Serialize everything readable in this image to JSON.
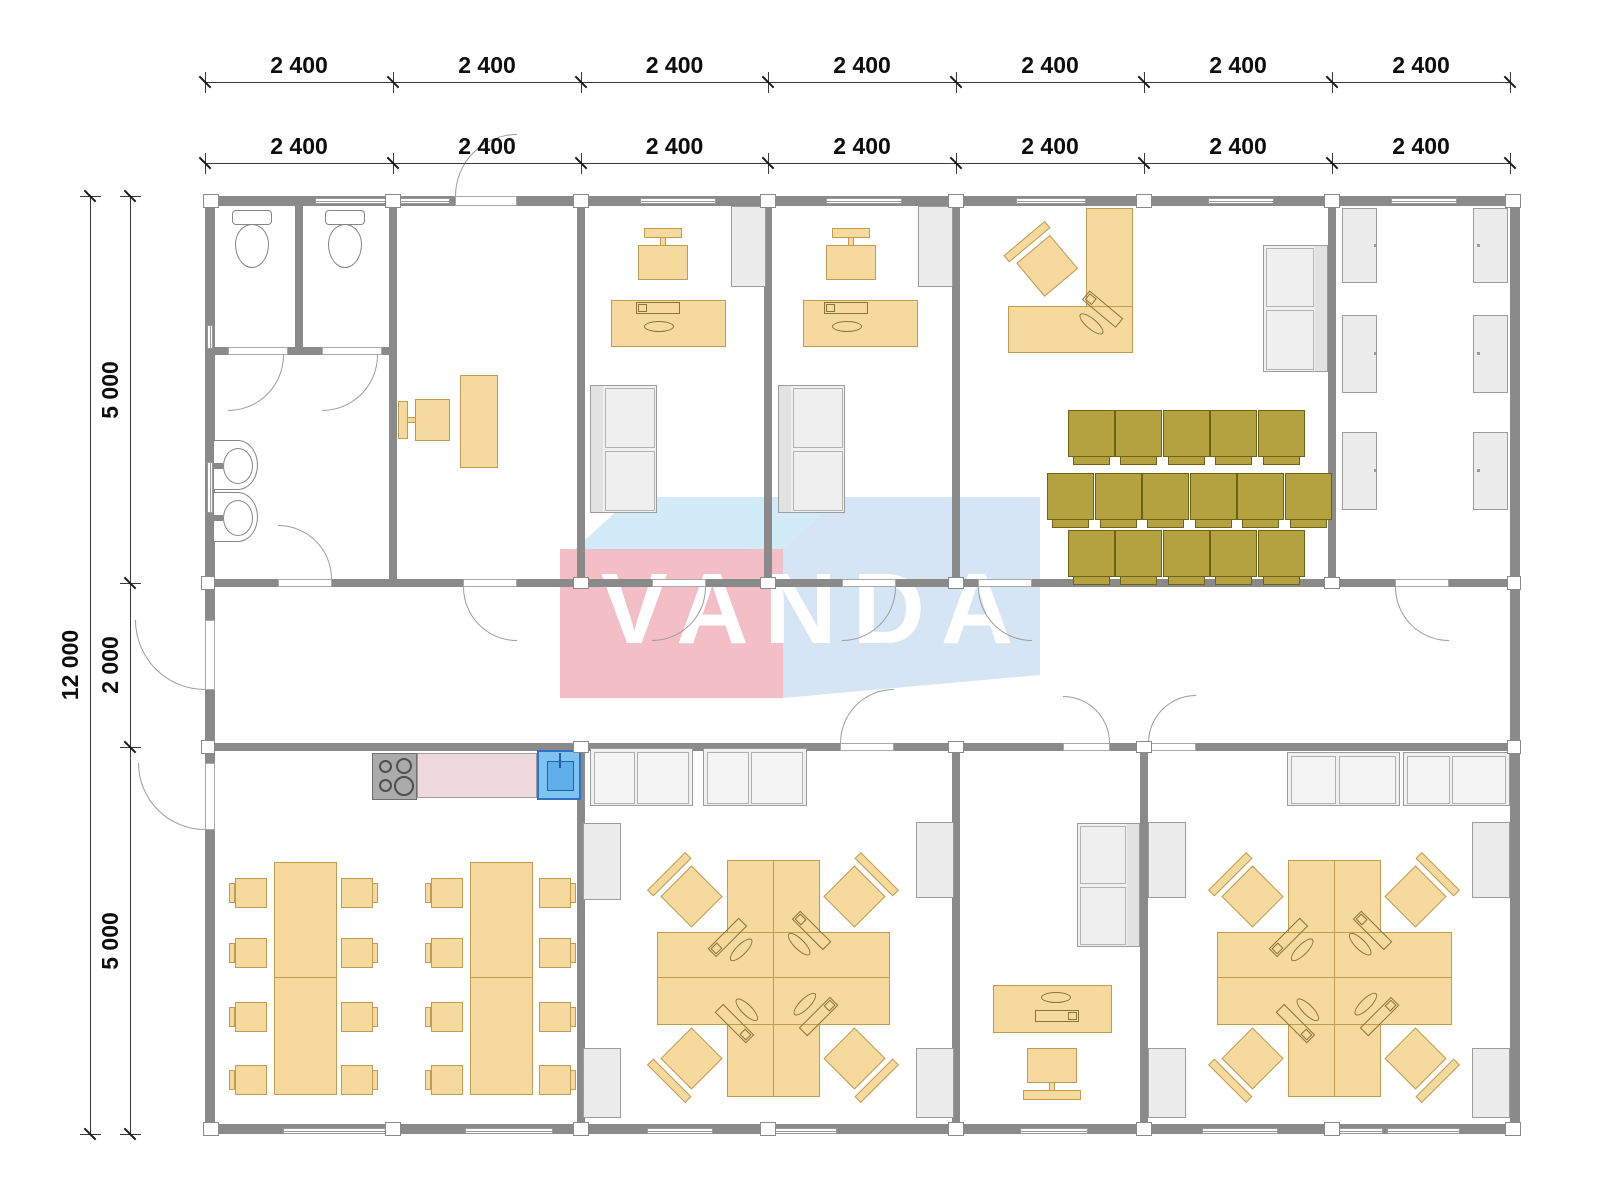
{
  "watermark": {
    "text": "VANDA",
    "front_color": "#f2b9c1",
    "top_color": "#cfeaf8",
    "side_color": "#d3e3f2",
    "text_color": "#ffffff"
  },
  "dimensions": {
    "top_row_1": [
      "2 400",
      "2 400",
      "2 400",
      "2 400",
      "2 400",
      "2 400",
      "2 400"
    ],
    "top_row_2": [
      "2 400",
      "2 400",
      "2 400",
      "2 400",
      "2 400",
      "2 400",
      "2 400"
    ],
    "left_total": "12 000",
    "left_segments": [
      "5 000",
      "2 000",
      "5 000"
    ]
  },
  "colors": {
    "wall": "#8a8a8a",
    "furniture_tan": "#f6d99c",
    "furniture_tan_border": "#bf9c52",
    "chair_olive": "#b3a23f",
    "gray_furniture": "#ececec",
    "counter_pink": "#eedade",
    "sink_blue": "#7fc3f0",
    "dim_text": "#0d0d0d"
  },
  "plan": {
    "cols": [
      205,
      393,
      581,
      768,
      956,
      1144,
      1332,
      1510
    ],
    "rows": [
      196,
      583,
      747,
      1134
    ],
    "dim": {
      "top_line_y": [
        82,
        163
      ],
      "top_label_y": [
        52,
        133
      ],
      "left_line_x": [
        90,
        130
      ],
      "left_label_x": [
        70,
        110
      ],
      "outer_rows": [
        196,
        1134
      ]
    },
    "walls": [
      [
        205,
        196,
        1315,
        10
      ],
      [
        205,
        1124,
        1315,
        10
      ],
      [
        205,
        196,
        10,
        938
      ],
      [
        1510,
        196,
        10,
        938
      ],
      [
        205,
        579,
        1305,
        8
      ],
      [
        205,
        743,
        1305,
        8
      ],
      [
        389,
        206,
        8,
        373
      ],
      [
        577,
        206,
        8,
        373
      ],
      [
        764,
        206,
        8,
        373
      ],
      [
        952,
        206,
        8,
        373
      ],
      [
        1328,
        206,
        8,
        373
      ],
      [
        295,
        206,
        8,
        149
      ],
      [
        211,
        347,
        178,
        8
      ],
      [
        577,
        751,
        8,
        373
      ],
      [
        952,
        751,
        8,
        373
      ],
      [
        1140,
        751,
        8,
        373
      ]
    ],
    "junctions": [
      [
        203,
        194,
        16,
        14
      ],
      [
        385,
        194,
        16,
        14
      ],
      [
        573,
        194,
        16,
        14
      ],
      [
        760,
        194,
        16,
        14
      ],
      [
        948,
        194,
        16,
        14
      ],
      [
        1136,
        194,
        16,
        14
      ],
      [
        1324,
        194,
        16,
        14
      ],
      [
        1505,
        194,
        16,
        14
      ],
      [
        203,
        1122,
        16,
        14
      ],
      [
        385,
        1122,
        16,
        14
      ],
      [
        573,
        1122,
        16,
        14
      ],
      [
        760,
        1122,
        16,
        14
      ],
      [
        948,
        1122,
        16,
        14
      ],
      [
        1136,
        1122,
        16,
        14
      ],
      [
        1324,
        1122,
        16,
        14
      ],
      [
        1505,
        1122,
        16,
        14
      ],
      [
        201,
        576,
        14,
        14
      ],
      [
        201,
        740,
        14,
        14
      ],
      [
        1507,
        576,
        14,
        14
      ],
      [
        1507,
        740,
        14,
        14
      ],
      [
        573,
        577,
        16,
        12
      ],
      [
        760,
        577,
        16,
        12
      ],
      [
        948,
        577,
        16,
        12
      ],
      [
        1324,
        577,
        16,
        12
      ],
      [
        573,
        741,
        16,
        12
      ],
      [
        948,
        741,
        16,
        12
      ],
      [
        1136,
        741,
        16,
        12
      ]
    ],
    "windows_h": [
      [
        315,
        198,
        135,
        6
      ],
      [
        640,
        198,
        76,
        6
      ],
      [
        826,
        198,
        76,
        6
      ],
      [
        1016,
        198,
        70,
        6
      ],
      [
        1208,
        198,
        66,
        6
      ],
      [
        1391,
        198,
        66,
        6
      ],
      [
        283,
        1128,
        114,
        6
      ],
      [
        465,
        1128,
        88,
        6
      ],
      [
        647,
        1128,
        66,
        6
      ],
      [
        767,
        1128,
        70,
        6
      ],
      [
        1020,
        1128,
        68,
        6
      ],
      [
        1202,
        1128,
        76,
        6
      ],
      [
        1332,
        1128,
        51,
        6
      ],
      [
        1387,
        1128,
        73,
        6
      ]
    ],
    "windows_v": [
      [
        207,
        325,
        6,
        24
      ],
      [
        207,
        462,
        6,
        51
      ]
    ],
    "door_leaves": [
      [
        278,
        579,
        54,
        8
      ],
      [
        463,
        579,
        54,
        8
      ],
      [
        652,
        579,
        54,
        8
      ],
      [
        842,
        579,
        54,
        8
      ],
      [
        978,
        579,
        54,
        8
      ],
      [
        1395,
        579,
        54,
        8
      ],
      [
        840,
        743,
        54,
        8
      ],
      [
        1063,
        743,
        47,
        8
      ],
      [
        1148,
        743,
        48,
        8
      ],
      [
        205,
        620,
        10,
        70
      ],
      [
        205,
        763,
        10,
        67
      ],
      [
        455,
        196,
        62,
        10
      ],
      [
        228,
        347,
        60,
        8
      ],
      [
        322,
        347,
        60,
        8
      ]
    ],
    "door_arcs": [
      [
        278,
        525,
        54,
        "bl"
      ],
      [
        463,
        587,
        54,
        "tr"
      ],
      [
        652,
        587,
        54,
        "tl"
      ],
      [
        842,
        587,
        54,
        "tl"
      ],
      [
        978,
        587,
        54,
        "tr"
      ],
      [
        1395,
        587,
        54,
        "tr"
      ],
      [
        840,
        689,
        54,
        "br"
      ],
      [
        1063,
        696,
        47,
        "bl"
      ],
      [
        1148,
        695,
        48,
        "br"
      ],
      [
        135,
        620,
        70,
        "tr"
      ],
      [
        138,
        763,
        67,
        "tr"
      ],
      [
        455,
        134,
        62,
        "br"
      ],
      [
        228,
        355,
        56,
        "tl"
      ],
      [
        322,
        355,
        56,
        "tl"
      ]
    ],
    "gray_rects": [
      [
        731,
        206,
        35,
        81
      ],
      [
        918,
        206,
        35,
        81
      ],
      [
        1342,
        208,
        35,
        75
      ],
      [
        1342,
        315,
        35,
        78
      ],
      [
        1342,
        432,
        35,
        78
      ],
      [
        1473,
        208,
        35,
        75
      ],
      [
        1473,
        315,
        35,
        78
      ],
      [
        1473,
        432,
        35,
        78
      ],
      [
        583,
        823,
        38,
        77
      ],
      [
        583,
        1048,
        38,
        70
      ],
      [
        916,
        822,
        38,
        76
      ],
      [
        916,
        1048,
        38,
        70
      ],
      [
        1148,
        822,
        38,
        76
      ],
      [
        1148,
        1048,
        38,
        70
      ],
      [
        1472,
        822,
        38,
        76
      ],
      [
        1472,
        1048,
        38,
        70
      ]
    ],
    "bed_dots": [
      [
        1374,
        244
      ],
      [
        1374,
        352
      ],
      [
        1374,
        469
      ],
      [
        1477,
        244
      ],
      [
        1477,
        352
      ],
      [
        1477,
        469
      ]
    ],
    "cabinets": [
      [
        590,
        748,
        103,
        58
      ],
      [
        703,
        748,
        104,
        58
      ],
      [
        1287,
        752,
        113,
        54
      ],
      [
        1403,
        752,
        107,
        54
      ]
    ],
    "sofas": [
      [
        590,
        385,
        67,
        128,
        "l"
      ],
      [
        778,
        385,
        67,
        128,
        "l"
      ],
      [
        1263,
        245,
        65,
        127,
        "r"
      ],
      [
        1077,
        823,
        63,
        124,
        "r"
      ]
    ],
    "tan_rects": [
      [
        460,
        375,
        38,
        93
      ],
      [
        611,
        300,
        115,
        47
      ],
      [
        803,
        300,
        115,
        47
      ],
      [
        1086,
        208,
        47,
        145
      ],
      [
        1008,
        306,
        125,
        47
      ],
      [
        993,
        985,
        119,
        48
      ],
      [
        727,
        860,
        93,
        237
      ],
      [
        657,
        932,
        233,
        93
      ],
      [
        1288,
        860,
        93,
        237
      ],
      [
        1217,
        932,
        235,
        93
      ]
    ],
    "tables": [
      [
        274,
        862,
        63,
        233
      ],
      [
        470,
        862,
        63,
        233
      ]
    ],
    "tan_lines": [
      [
        274,
        977,
        63,
        1
      ],
      [
        470,
        977,
        63,
        1
      ],
      [
        773,
        860,
        1,
        237
      ],
      [
        657,
        977,
        233,
        1
      ],
      [
        1334,
        860,
        1,
        237
      ],
      [
        1217,
        977,
        235,
        1
      ]
    ],
    "toilets": [
      [
        252,
        210
      ],
      [
        345,
        210
      ]
    ],
    "sinks": [
      [
        213,
        440
      ],
      [
        213,
        492
      ]
    ],
    "stove": [
      372,
      753,
      45,
      47
    ],
    "counter": [
      417,
      753,
      120,
      45
    ],
    "sink_unit": [
      537,
      750,
      44,
      50
    ],
    "olive_chairs": [
      [
        1068,
        410
      ],
      [
        1115,
        410
      ],
      [
        1163,
        410
      ],
      [
        1210,
        410
      ],
      [
        1258,
        410
      ],
      [
        1047,
        473
      ],
      [
        1095,
        473
      ],
      [
        1142,
        473
      ],
      [
        1190,
        473
      ],
      [
        1237,
        473
      ],
      [
        1285,
        473
      ],
      [
        1068,
        530
      ],
      [
        1115,
        530
      ],
      [
        1163,
        530
      ],
      [
        1210,
        530
      ],
      [
        1258,
        530
      ]
    ],
    "dine_chairs": [
      [
        235,
        878,
        "l"
      ],
      [
        235,
        938,
        "l"
      ],
      [
        235,
        1002,
        "l"
      ],
      [
        235,
        1065,
        "l"
      ],
      [
        341,
        878,
        "r"
      ],
      [
        341,
        938,
        "r"
      ],
      [
        341,
        1002,
        "r"
      ],
      [
        341,
        1065,
        "r"
      ],
      [
        431,
        878,
        "l"
      ],
      [
        431,
        938,
        "l"
      ],
      [
        431,
        1002,
        "l"
      ],
      [
        431,
        1065,
        "l"
      ],
      [
        539,
        878,
        "r"
      ],
      [
        539,
        938,
        "r"
      ],
      [
        539,
        1002,
        "r"
      ],
      [
        539,
        1065,
        "r"
      ]
    ],
    "office_chairs": [
      [
        663,
        228,
        "t"
      ],
      [
        851,
        228,
        "t"
      ],
      [
        1052,
        1048,
        "b"
      ],
      [
        398,
        420,
        "l"
      ]
    ],
    "diamond_chairs": [
      [
        688,
        893,
        -45
      ],
      [
        858,
        893,
        45
      ],
      [
        688,
        1062,
        -135
      ],
      [
        858,
        1062,
        135
      ],
      [
        1249,
        893,
        -45
      ],
      [
        1419,
        893,
        45
      ],
      [
        1249,
        1062,
        -135
      ],
      [
        1419,
        1062,
        135
      ],
      [
        1044,
        262,
        -40
      ]
    ],
    "pcs": [
      [
        663,
        318,
        0
      ],
      [
        851,
        318,
        0
      ],
      [
        738,
        941,
        -45
      ],
      [
        808,
        941,
        45
      ],
      [
        738,
        1013,
        -135
      ],
      [
        808,
        1013,
        135
      ],
      [
        1299,
        941,
        -45
      ],
      [
        1369,
        941,
        45
      ],
      [
        1299,
        1013,
        -135
      ],
      [
        1369,
        1013,
        135
      ],
      [
        1100,
        320,
        40
      ],
      [
        1052,
        1006,
        180
      ]
    ]
  }
}
